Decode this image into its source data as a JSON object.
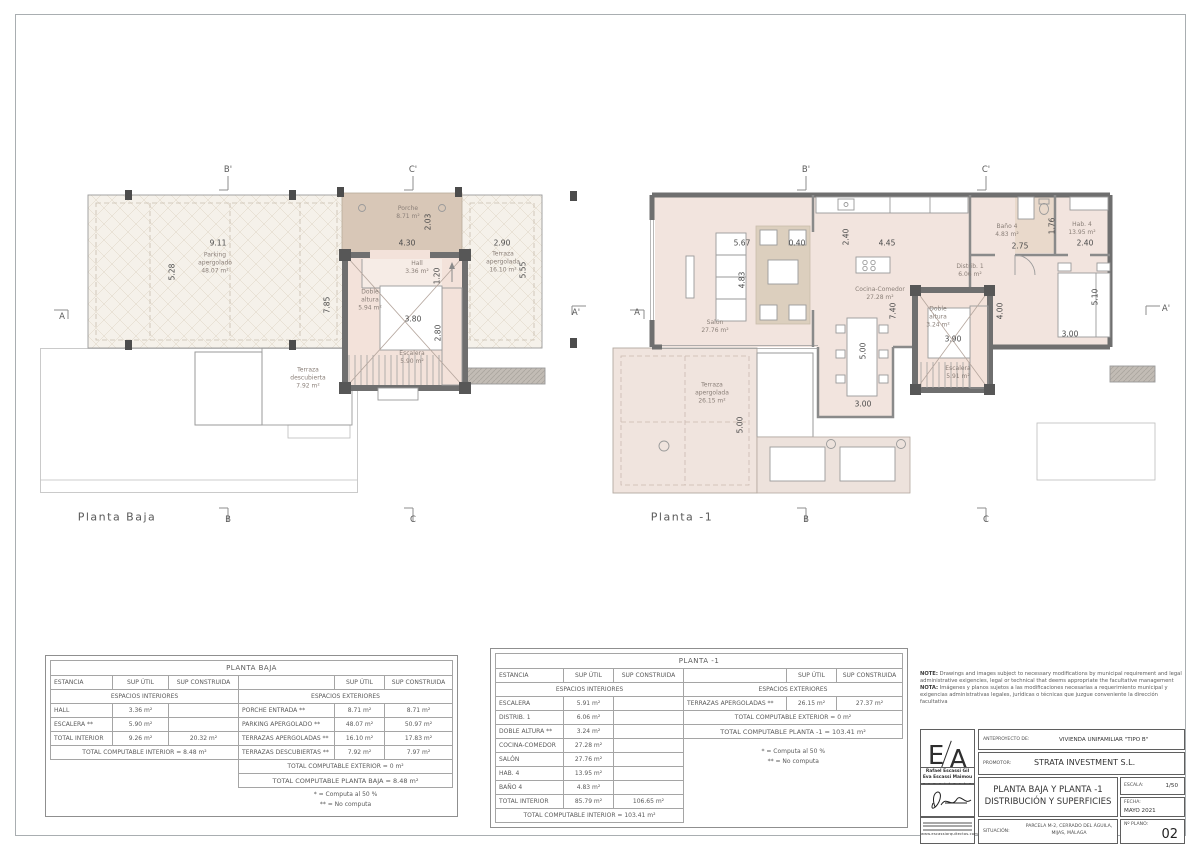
{
  "colors": {
    "wall": "#6f6f6f",
    "interior_fill": "#f2e4de",
    "pergola_fill": "#f5f1ea",
    "porch_fill": "#d8c7b7",
    "core_fill": "#f3e2da",
    "rug_fill": "#dccfbe"
  },
  "markers": {
    "a": "A",
    "a_p": "A'",
    "b": "B",
    "b_p": "B'",
    "c": "C",
    "c_p": "C'"
  },
  "plan_baja": {
    "title": "Planta Baja",
    "rooms": {
      "parking": {
        "name": "Parking apergolado",
        "area": "48.07 m²"
      },
      "porche": {
        "name": "Porche",
        "area": "8.71 m²"
      },
      "hall": {
        "name": "Hall",
        "area": "3.36 m²"
      },
      "doble_altura": {
        "name": "Doble altura",
        "area": "5.94 m²"
      },
      "escalera": {
        "name": "Escalera",
        "area": "5.90 m²"
      },
      "terraza_apergolada": {
        "name": "Terraza apergolada",
        "area": "16.10 m²"
      },
      "terraza_descubierta": {
        "name": "Terraza descubierta",
        "area": "7.92 m²"
      }
    },
    "dims": {
      "w_parking": "9.11",
      "h_parking": "5.28",
      "h_total": "7.85",
      "w_porche": "4.30",
      "h_porche": "2.03",
      "h_hall": "1.20",
      "w_core": "3.80",
      "h_core": "2.80",
      "w_terraza": "2.90",
      "h_terraza": "5.55"
    }
  },
  "plan_m1": {
    "title": "Planta -1",
    "rooms": {
      "salon": {
        "name": "Salón",
        "area": "27.76 m²"
      },
      "cocina": {
        "name": "Cocina-Comedor",
        "area": "27.28 m²"
      },
      "bano": {
        "name": "Baño 4",
        "area": "4.83 m²"
      },
      "hab": {
        "name": "Hab. 4",
        "area": "13.95 m²"
      },
      "distrib": {
        "name": "Distrib. 1",
        "area": "6.06 m²"
      },
      "doble_altura": {
        "name": "Doble altura",
        "area": "3.24 m²"
      },
      "escalera": {
        "name": "Escalera",
        "area": "5.91 m²"
      },
      "terraza": {
        "name": "Terraza apergolada",
        "area": "26.15 m²"
      }
    },
    "dims": {
      "w_salon": "5.67",
      "w_gap": "0.40",
      "h_cocina": "2.40",
      "w_cocina": "4.45",
      "h_salon": "4.83",
      "h_total": "7.40",
      "h_mesa": "5.00",
      "w_mesa": "3.00",
      "w_bano": "2.75",
      "h_bano": "1.76",
      "w_hab": "2.40",
      "h_hab": "5.10",
      "w_cama": "3.00",
      "w_core": "3.90",
      "h_core": "4.00",
      "h_terraza": "5.00"
    }
  },
  "table_baja": {
    "title": "PLANTA BAJA",
    "h_estancia": "ESTANCIA",
    "h_util": "SUP ÚTIL",
    "h_construida": "SUP CONSTRUIDA",
    "interior_header": "ESPACIOS INTERIORES",
    "exterior_header": "ESPACIOS EXTERIORES",
    "int_rows": [
      [
        "HALL",
        "3.36 m²",
        ""
      ],
      [
        "ESCALERA **",
        "5.90 m²",
        ""
      ],
      [
        "TOTAL INTERIOR",
        "9.26 m²",
        "20.32 m²"
      ]
    ],
    "int_total": "TOTAL COMPUTABLE INTERIOR = 8.48 m²",
    "ext_rows": [
      [
        "PORCHE ENTRADA **",
        "8.71 m²",
        "8.71 m²"
      ],
      [
        "PARKING APERGOLADO **",
        "48.07 m²",
        "50.97 m²"
      ],
      [
        "TERRAZAS APERGOLADAS **",
        "16.10 m²",
        "17.83 m²"
      ],
      [
        "TERRAZAS DESCUBIERTAS **",
        "7.92 m²",
        "7.97 m²"
      ]
    ],
    "ext_total": "TOTAL COMPUTABLE EXTERIOR = 0 m²",
    "planta_total": "TOTAL COMPUTABLE PLANTA BAJA = 8.48 m²",
    "fn1": "* = Computa al 50 %",
    "fn2": "** = No computa"
  },
  "table_m1": {
    "title": "PLANTA  -1",
    "h_estancia": "ESTANCIA",
    "h_util": "SUP ÚTIL",
    "h_construida": "SUP CONSTRUIDA",
    "interior_header": "ESPACIOS INTERIORES",
    "exterior_header": "ESPACIOS EXTERIORES",
    "int_rows": [
      [
        "ESCALERA",
        "5.91 m²",
        ""
      ],
      [
        "DISTRIB. 1",
        "6.06 m²",
        ""
      ],
      [
        "DOBLE ALTURA **",
        "3.24 m²",
        ""
      ],
      [
        "COCINA-COMEDOR",
        "27.28 m²",
        ""
      ],
      [
        "SALÓN",
        "27.76 m²",
        ""
      ],
      [
        "HAB. 4",
        "13.95 m²",
        ""
      ],
      [
        "BAÑO 4",
        "4.83 m²",
        ""
      ],
      [
        "TOTAL INTERIOR",
        "85.79 m²",
        "106.65 m²"
      ]
    ],
    "int_total": "TOTAL COMPUTABLE INTERIOR = 103.41 m²",
    "ext_rows": [
      [
        "TERRAZAS APERGOLADAS **",
        "26.15 m²",
        "27.37 m²"
      ]
    ],
    "ext_total": "TOTAL COMPUTABLE EXTERIOR = 0 m²",
    "planta_total": "TOTAL COMPUTABLE PLANTA -1 = 103.41 m²",
    "fn1": "* = Computa al 50 %",
    "fn2": "** = No computa"
  },
  "titleblock": {
    "note_en_label": "NOTE:",
    "note_en": "Drawings and images subject to necessary modifications by municipal requirement and legal administrative exigencies, legal or technical that deems appropriate the facultative management",
    "note_es_label": "NOTA:",
    "note_es": "Imágenes y planos sujetos a las modificaciones necesarias a requerimiento municipal y exigencias administrativas legales, jurídicas o técnicas que juzgue conveniente la dirección facultativa",
    "logo_e": "E",
    "logo_a": "A",
    "arch1": "Rafael Escassi Gil",
    "arch2": "Eva Escassi Maimou",
    "arch3": "a r q u i t e c t o s",
    "web": "www.escassiarquitectos.com",
    "anteproyecto_label": "ANTEPROYECTO DE:",
    "anteproyecto": "VIVIENDA UNIFAMILIAR \"TIPO B\"",
    "promotor_label": "PROMOTOR:",
    "promotor": "STRATA INVESTMENT S.L.",
    "title1": "PLANTA BAJA Y PLANTA -1",
    "title2": "DISTRIBUCIÓN Y SUPERFICIES",
    "escala_label": "ESCALA:",
    "escala": "1/50",
    "fecha_label": "FECHA:",
    "fecha": "MAYO 2021",
    "situacion_label": "SITUACIÓN:",
    "situacion": "PARCELA M-2, CERRADO DEL ÁGUILA, MIJAS, MÁLAGA",
    "nplano_label": "Nº PLANO:",
    "nplano": "02"
  }
}
